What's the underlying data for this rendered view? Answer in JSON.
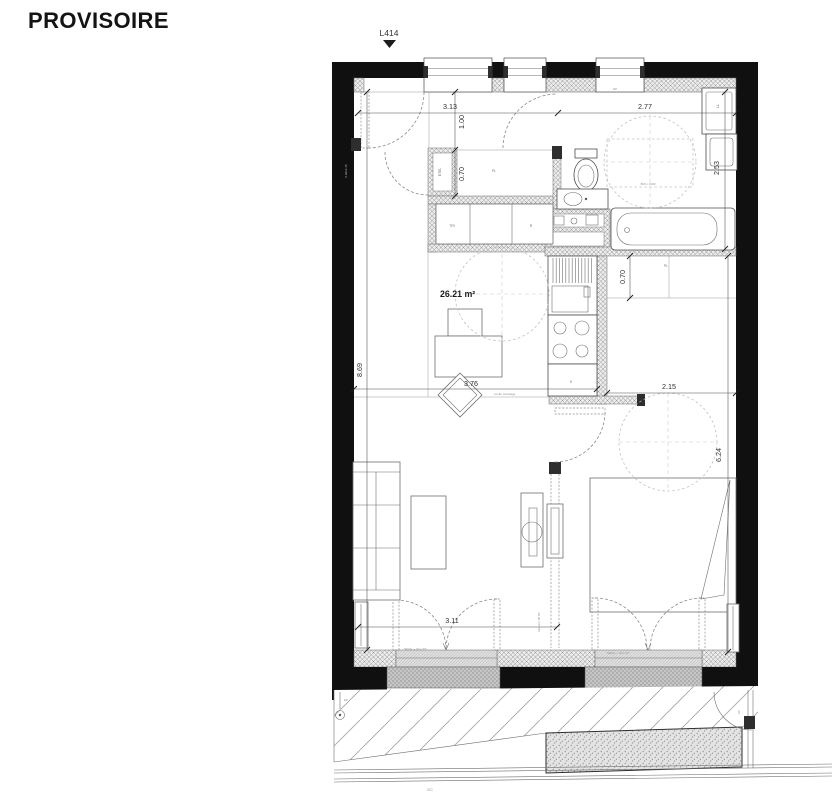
{
  "header": {
    "watermark": "PROVISOIRE",
    "lot": "L414"
  },
  "area_label": "26.21 m²",
  "dims": {
    "entry_w": "3.13",
    "corridor_d": "1.00",
    "bath_w": "2.77",
    "bath_d": "2.53",
    "closet_d": "0.70",
    "living_l": "8.69",
    "living_w": "3.76",
    "dressing_d": "0.70",
    "bedroom_w": "2.15",
    "bedroom_l": "6.24",
    "window_w": "3.11"
  },
  "labels": {
    "etel": "ETEL",
    "placard_entry": "PL",
    "wardrobe_tri": "TRI",
    "wardrobe_r": "R",
    "kitchen_s": "S",
    "washer": "LL",
    "np": "NP",
    "placard_dressing": "PL",
    "door_leaf_size": "0.90x2.15"
  },
  "annotations": {
    "seuil_living": "SEUIL + 3cm ST",
    "seuil_bedroom": "SEUIL + 3cm ST",
    "limite_carrelage": "Limite carrelage",
    "access_zone": "800 x 1300",
    "gc": "GC",
    "ep_left": "EP",
    "ep_right": "EP",
    "nf": "Intérieur 80 NF"
  }
}
